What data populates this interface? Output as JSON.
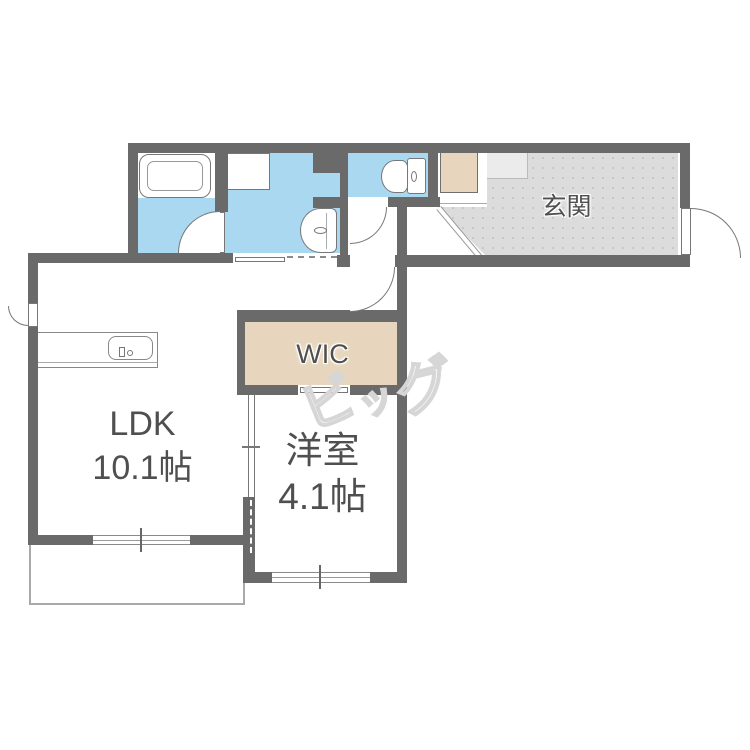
{
  "type": "floor_plan",
  "rooms": {
    "ldk": {
      "label": "LDK",
      "size": "10.1帖"
    },
    "bedroom": {
      "label": "洋室",
      "size": "4.1帖"
    },
    "wic": {
      "label": "WIC"
    },
    "entrance": {
      "label": "玄関"
    }
  },
  "watermark": {
    "text": "ビッグ",
    "chars": [
      "ビ",
      "ッ",
      "グ"
    ]
  },
  "fixtures": [
    "bathtub",
    "washing-machine-pan",
    "washbasin",
    "toilet",
    "kitchen-counter",
    "kitchen-sink",
    "shoe-cabinet",
    "balcony"
  ],
  "colors": {
    "wall": "#6a6a6a",
    "water": "#aad8f1",
    "beige": "#e7d6bd",
    "genkan": "#dcdcdc",
    "step": "#ebebeb",
    "line": "#777777",
    "text": "#4f4f4f",
    "watermark": "#d6d6d6",
    "balcony": "#a9a9a9"
  }
}
